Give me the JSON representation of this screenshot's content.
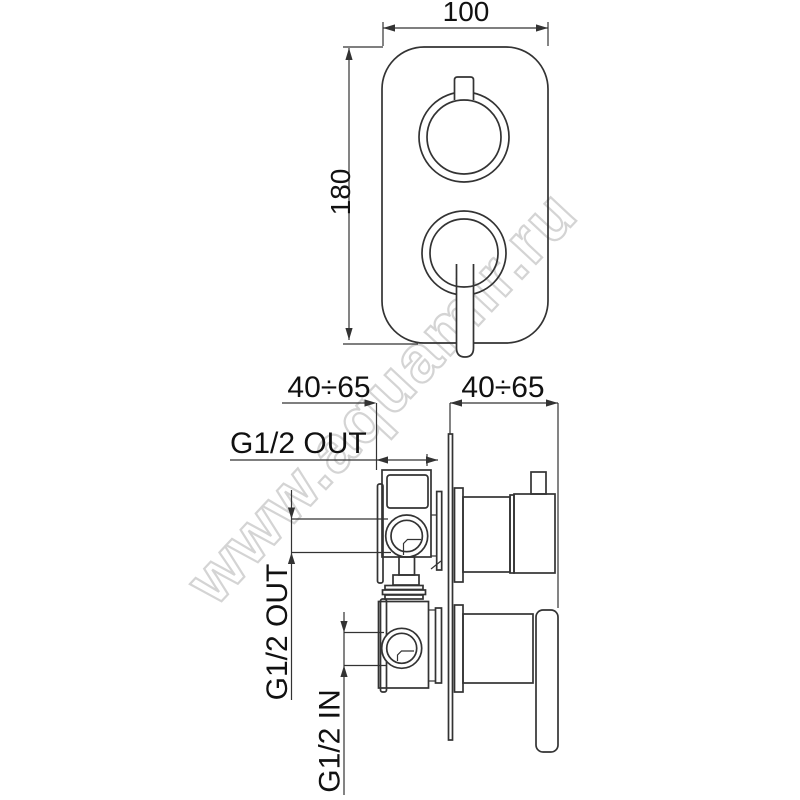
{
  "meta": {
    "drawing_type": "technical dimension drawing",
    "subject": "concealed thermostatic shower mixer valve, front view and side section view"
  },
  "colors": {
    "background": "#ffffff",
    "line": "#333333",
    "text": "#111111",
    "watermark_stroke": "#d2d2d2"
  },
  "watermark": {
    "text": "www.aquamir.ru"
  },
  "front_view": {
    "width_dim": {
      "label": "100"
    },
    "height_dim": {
      "label": "180"
    }
  },
  "side_view": {
    "depth_dim_left": {
      "label": "40÷65"
    },
    "depth_dim_right": {
      "label": "40÷65"
    },
    "top_outlet": {
      "label": "G1/2 OUT"
    },
    "side_outlet": {
      "label": "G1/2 OUT"
    },
    "inlet": {
      "label": "G1/2 IN"
    }
  }
}
